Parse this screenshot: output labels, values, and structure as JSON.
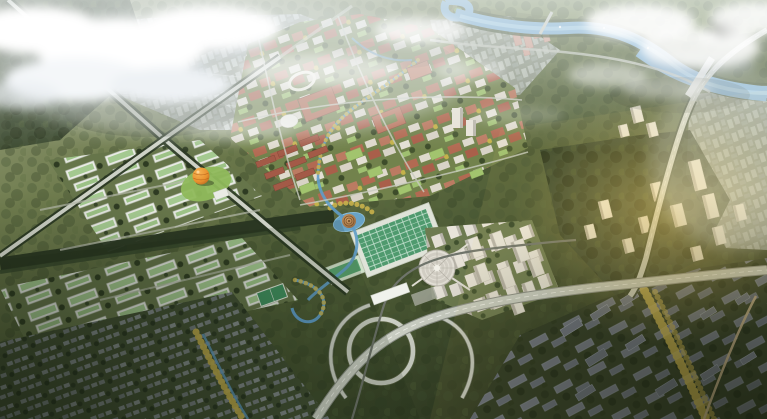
{
  "palette": {
    "haze": "#edf2f4",
    "cloud": "#ffffff",
    "cloud_shadow": "#bcc6cf",
    "ground_light": "#a6ab8d",
    "ground_mid": "#68764a",
    "ground_dark": "#2d3822",
    "forest": "#3f5030",
    "forest_dark": "#283521",
    "river": "#7badd1",
    "river_highlight": "#a9d1ea",
    "canal": "#5f9cc8",
    "road": "#cdd1c6",
    "road_edge": "#8e928a",
    "rail": "#6f746b",
    "roof_green": "#a4c990",
    "court_green": "#4f9a6e",
    "pitch_green": "#3f8f5f",
    "building_white": "#e9ebe4",
    "building_terracotta": "#b26a52",
    "building_red": "#a35a47",
    "building_gray": "#6e7583",
    "tree_gold": "#c9b14b",
    "lawn_green": "#8fba5c",
    "sphere_orange": "#e8922f",
    "sphere_orange_light": "#f6b455",
    "dome_white": "#e2dfd5",
    "pavilion_brown": "#a97a4d",
    "sun_gold": "#f2cf6d",
    "shadow": "#141b0f"
  },
  "regions": [
    "clouds-left",
    "clouds-right",
    "distant-city",
    "river",
    "river-bridge",
    "riverside-towers",
    "campus-north",
    "industrial-park-upper",
    "industrial-park-lower",
    "green-corridor",
    "housing-grid",
    "white-tower-cluster",
    "spiral-dome-building",
    "rooftop-sports-complex",
    "lake-dome-pavilion",
    "orange-sphere-pavilion",
    "football-pitch",
    "elevated-highway",
    "interchange-loop",
    "rail-line",
    "rail-station",
    "residential-towers-east",
    "residential-dark-east",
    "suburb-far-east",
    "gold-tree-band",
    "sun-glow",
    "haze-overlay"
  ]
}
